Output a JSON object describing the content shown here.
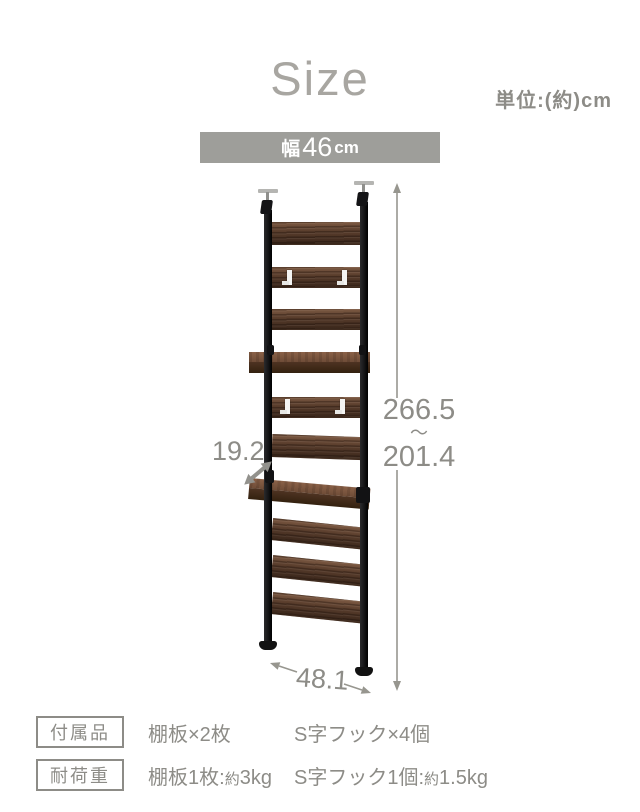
{
  "title": "Size",
  "unit_note": "単位:(約)cm",
  "banner": {
    "prefix": "幅",
    "value": "46",
    "unit": "cm"
  },
  "dimensions": {
    "height_max": "266.5",
    "height_range_tilde": "〜",
    "height_min": "201.4",
    "depth": "19.2",
    "width_floor": "48.1"
  },
  "specs": {
    "accessories": {
      "label": "付属品",
      "shelf_boards": "棚板×2枚",
      "s_hooks": "S字フック×4個"
    },
    "load_capacity": {
      "label": "耐荷重",
      "shelf_prefix": "棚板1枚:",
      "shelf_approx": "約",
      "shelf_value": "3kg",
      "hook_prefix": "S字フック1個:",
      "hook_approx": "約",
      "hook_value": "1.5kg"
    }
  },
  "colors": {
    "bg": "#ffffff",
    "title_gray": "#a8a6a1",
    "text_gray": "#8d8c87",
    "line_gray": "#97968f",
    "banner_bg": "#9e9e9a",
    "banner_text": "#ffffff",
    "wood_light": "#7d5a43",
    "wood_mid": "#593d2c",
    "wood_dark": "#3c281c",
    "pole_black": "#1b1b1d",
    "hook_white": "#f4f4f2",
    "metal_silver": "#b5b5b2"
  }
}
